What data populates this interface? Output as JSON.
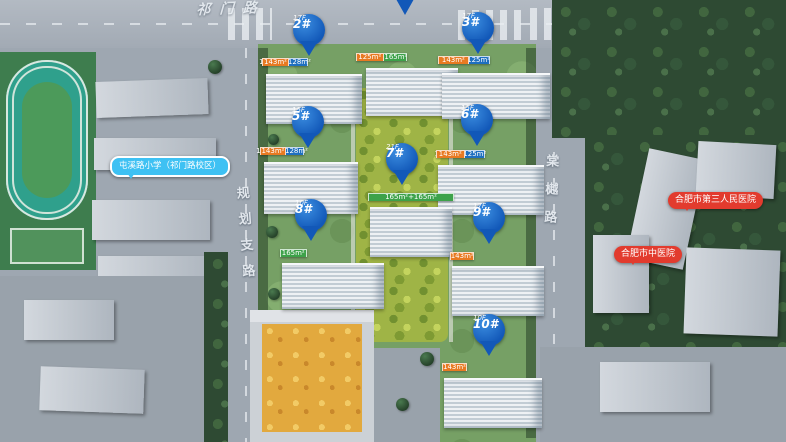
{
  "scene": {
    "width": 786,
    "height": 442,
    "description": "aerial rendering of residential development site plan"
  },
  "roads": {
    "top": "祁门路",
    "left": "规划支路",
    "right": "棠樾路"
  },
  "pois": {
    "school": "屯溪路小学（祁门路校区）",
    "hospital_1": "合肥市第三人民医院",
    "hospital_2": "合肥市中医院"
  },
  "buildings": {
    "b1": {
      "units": [
        "125m²",
        "165m²+165m²",
        "125m²"
      ]
    },
    "b2": {
      "pin": "2#",
      "floors": "17F",
      "units": [
        "143m²",
        "128m²+128m²",
        "143m²"
      ]
    },
    "b3": {
      "pin": "3#",
      "floors": "17F",
      "units": [
        "143m²",
        "125m²+125m²",
        "143m²"
      ]
    },
    "b5": {
      "pin": "5#",
      "floors": "15F",
      "units": [
        "143m²",
        "128m²+128m²",
        "143m²"
      ]
    },
    "b6": {
      "pin": "6#",
      "floors": "15F",
      "units": [
        "143m²",
        "125m²+125m²",
        "143m²"
      ]
    },
    "b7": {
      "pin": "7#",
      "floors": "21F",
      "units": [
        "165m²+165m²"
      ]
    },
    "b8": {
      "pin": "8#",
      "floors": "10F",
      "units": [
        "165m²",
        "165m²",
        "165m²",
        "165m²"
      ]
    },
    "b9": {
      "pin": "9#",
      "floors": "17F",
      "units": [
        "143m²",
        "125m²",
        "125m²",
        "143m²"
      ]
    },
    "b10": {
      "pin": "10#",
      "floors": "10F",
      "units": [
        "143m²",
        "143m²",
        "143m²",
        "143m²"
      ]
    }
  },
  "colors": {
    "pin_blue": "#1258B8",
    "unit_orange": "#E87A22",
    "unit_blue": "#1E6FC0",
    "unit_green": "#3DA24A",
    "poi_red": "#E23B2E",
    "poi_lightblue": "#3EC1F3"
  }
}
